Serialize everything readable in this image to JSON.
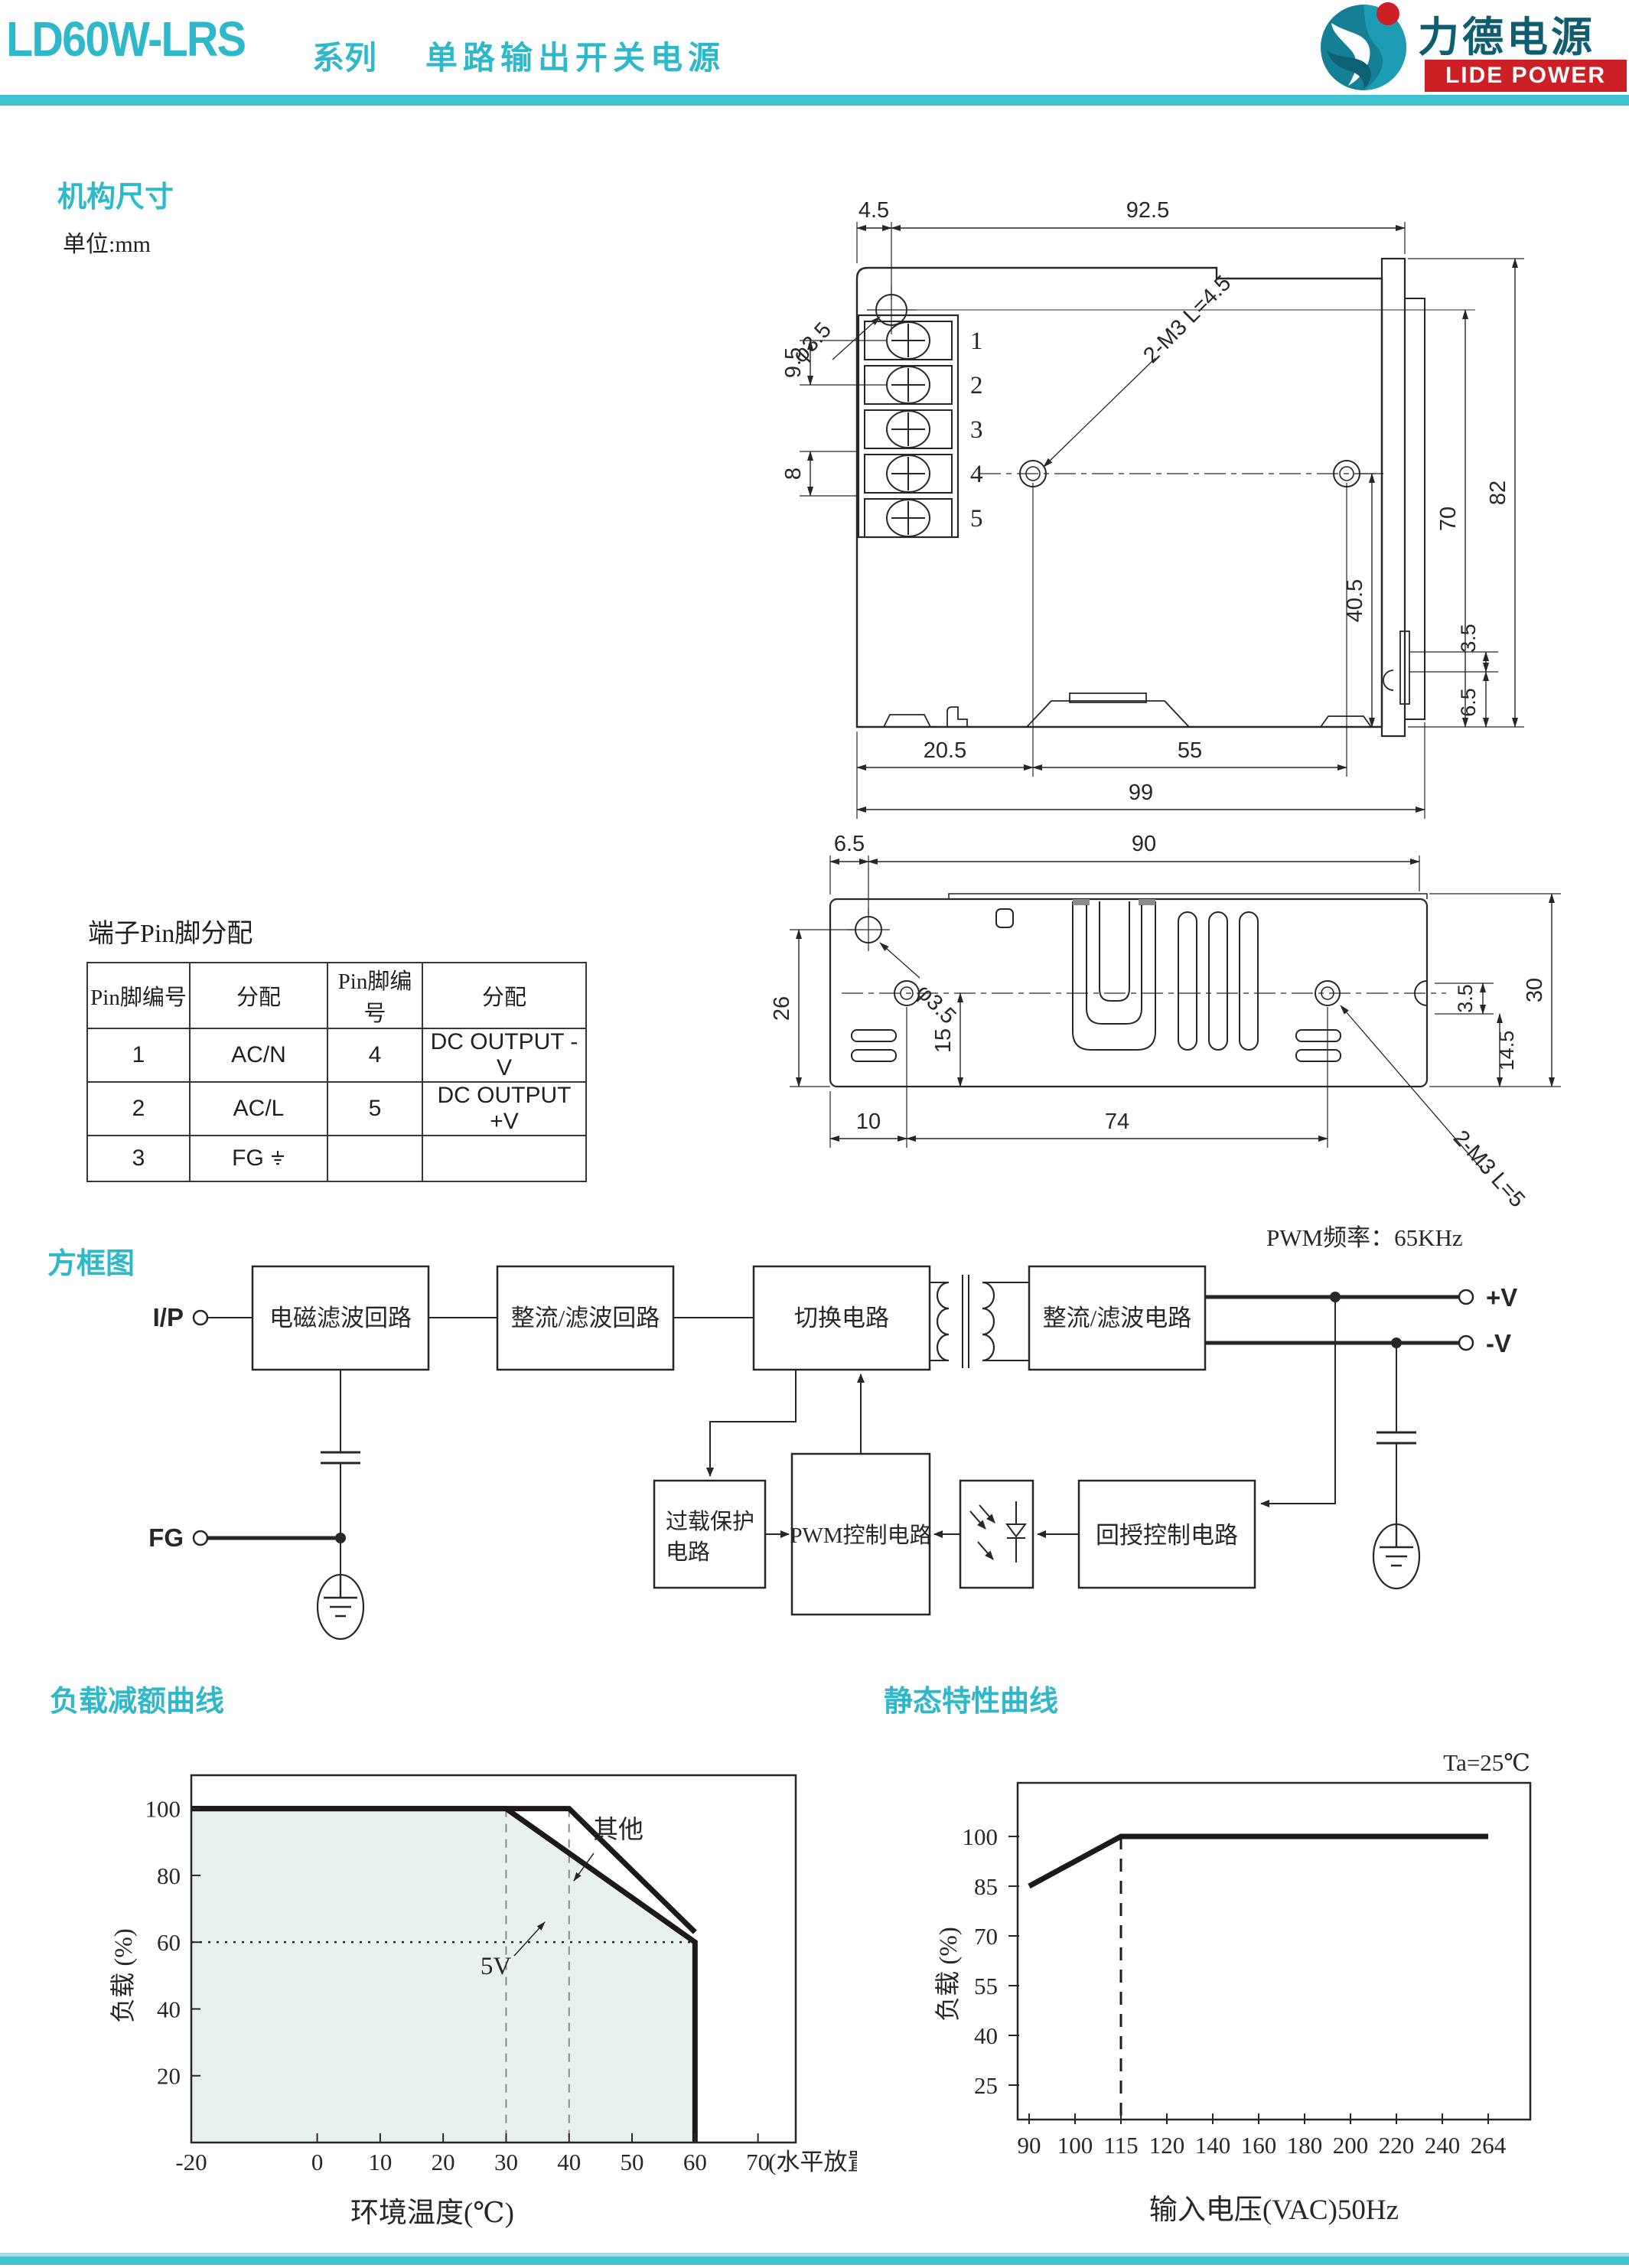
{
  "header": {
    "model": "LD60W-LRS",
    "series": "系列",
    "desc": "单路输出开关电源"
  },
  "logo": {
    "cn": "力德电源",
    "en": "LIDE POWER"
  },
  "colors": {
    "accent": "#2eb8ca",
    "bar": "#3fc2d2",
    "logo_red": "#cc1f26",
    "logo_teal": "#157f95",
    "line": "#2a2627",
    "chart_fill": "#e9f1ef"
  },
  "mech": {
    "section_title": "机构尺寸",
    "unit": "单位:mm",
    "front": {
      "terminals": [
        "1",
        "2",
        "3",
        "4",
        "5"
      ],
      "dims": {
        "d45": "4.5",
        "d925": "92.5",
        "phi35": "φ3.5",
        "d95": "9.5",
        "d8": "8",
        "m3": "2-M3 L=4.5",
        "d405": "40.5",
        "d70": "70",
        "d82": "82",
        "d35": "3.5",
        "d65": "6.5",
        "d205": "20.5",
        "d55": "55",
        "d99": "99"
      }
    },
    "bottom": {
      "dims": {
        "d65": "6.5",
        "d90": "90",
        "phi35": "φ3.5",
        "d26": "26",
        "d15": "15",
        "d10": "10",
        "d74": "74",
        "d35": "3.5",
        "d145": "14.5",
        "d30": "30",
        "m3": "2-M3 L=5"
      }
    }
  },
  "pin_table": {
    "title": "端子Pin脚分配",
    "headers": [
      "Pin脚编号",
      "分配",
      "Pin脚编号",
      "分配"
    ],
    "rows": [
      [
        "1",
        "AC/N",
        "4",
        "DC OUTPUT -V"
      ],
      [
        "2",
        "AC/L",
        "5",
        "DC OUTPUT +V"
      ],
      [
        "3",
        "FG",
        "",
        ""
      ]
    ]
  },
  "block_diagram": {
    "section_title": "方框图",
    "pwm_note": "PWM频率：65KHz",
    "labels": {
      "ip": "I/P",
      "fg": "FG",
      "emi": "电磁滤波回路",
      "rect1": "整流/滤波回路",
      "switch": "切换电路",
      "rect2": "整流/滤波电路",
      "overload1": "过载保护",
      "overload2": "电路",
      "pwm": "PWM控制电路",
      "feedback": "回授控制电路",
      "vplus": "+V",
      "vminus": "-V"
    }
  },
  "charts": {
    "derating_title": "负载减额曲线",
    "static_title": "静态特性曲线"
  },
  "chart_data": [
    {
      "type": "line",
      "title": "负载减额曲线",
      "xlabel": "环境温度(℃)",
      "ylabel": "负载 (%)",
      "x_note": "(水平放置)",
      "x_ticks": [
        -20,
        0,
        10,
        20,
        30,
        40,
        50,
        60,
        70
      ],
      "y_ticks": [
        20,
        40,
        60,
        80,
        100
      ],
      "xlim": [
        -20,
        76
      ],
      "ylim": [
        0,
        110
      ],
      "series": [
        {
          "name": "5V",
          "points": [
            [
              -20,
              100
            ],
            [
              30,
              100
            ],
            [
              60,
              60
            ],
            [
              60,
              0
            ]
          ]
        },
        {
          "name": "其他",
          "points": [
            [
              -20,
              100
            ],
            [
              40,
              100
            ],
            [
              60,
              63
            ]
          ]
        }
      ],
      "guides": {
        "dashed_vlines": [
          30,
          40
        ],
        "dotted_hline": 60
      },
      "fill_color": "#e9f1ef",
      "legend_position": "inline-annotations",
      "grid": false
    },
    {
      "type": "line",
      "title": "静态特性曲线",
      "xlabel": "输入电压(VAC)50Hz",
      "ylabel": "负载 (%)",
      "annotation": "Ta=25℃",
      "x_scale": "ordinal",
      "x_ticks": [
        90,
        100,
        115,
        120,
        140,
        160,
        180,
        200,
        220,
        240,
        264
      ],
      "y_ticks": [
        25,
        40,
        55,
        70,
        85,
        100
      ],
      "series": [
        {
          "name": "load",
          "points": [
            [
              90,
              85
            ],
            [
              115,
              100
            ],
            [
              264,
              100
            ]
          ]
        }
      ],
      "guides": {
        "dashed_vline": 115
      },
      "grid": false
    }
  ]
}
